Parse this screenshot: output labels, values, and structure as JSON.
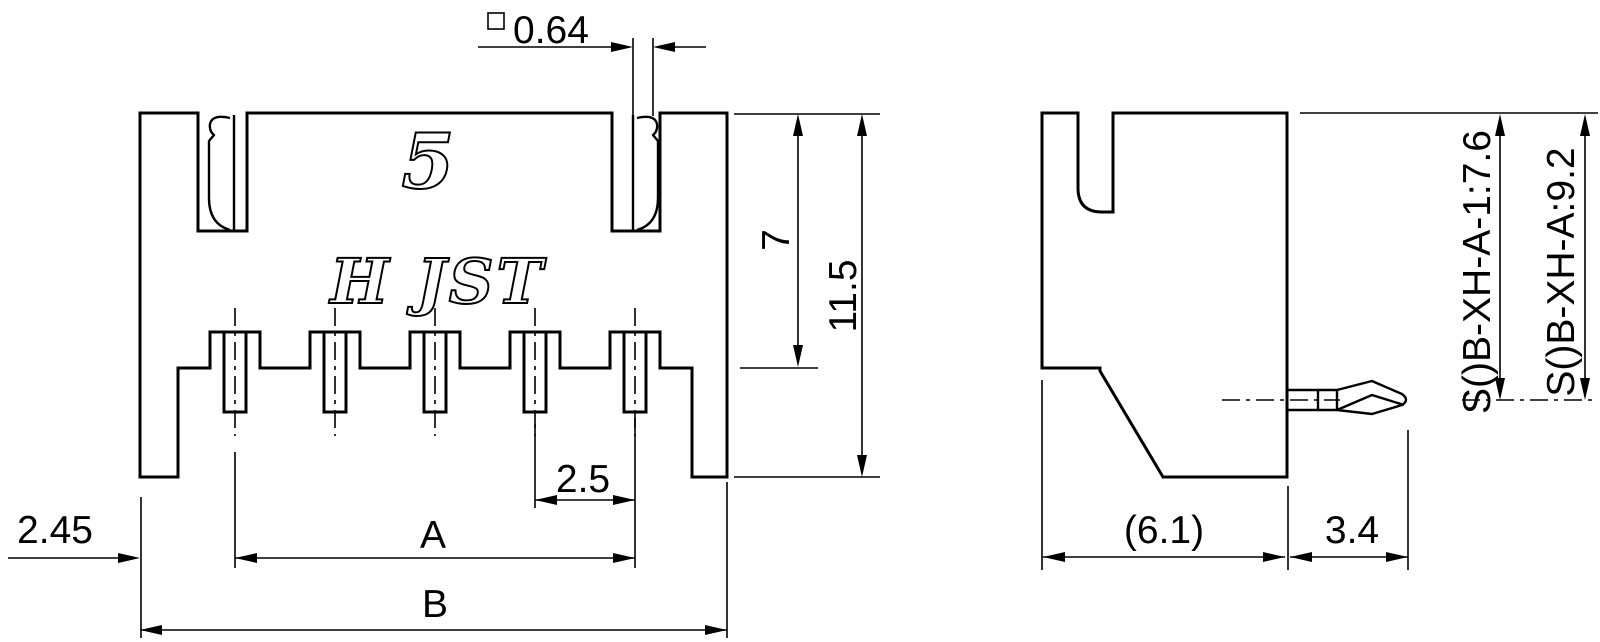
{
  "front_view": {
    "markings": {
      "pin_count": "5",
      "brand": "H JST"
    },
    "dims": {
      "pin_square": "0.64",
      "height_to_base": "7",
      "height_total": "11.5",
      "pitch": "2.5",
      "edge_to_pin1": "2.45",
      "pin_span_label": "A",
      "overall_width_label": "B"
    }
  },
  "side_view": {
    "dims": {
      "body_depth": "(6.1)",
      "pin_protrusion": "3.4",
      "part_height_1": "S()B-XH-A-1:7.6",
      "part_height_2": "S()B-XH-A:9.2"
    }
  },
  "colors": {
    "line": "#000000",
    "background": "#ffffff"
  }
}
